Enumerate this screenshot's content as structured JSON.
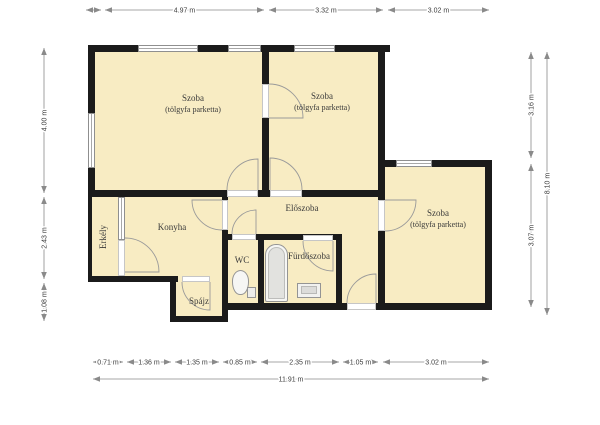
{
  "colors": {
    "room_fill": "#F8ECC3",
    "wall": "#1b1b1b",
    "dim_line": "#8a8a8a",
    "dim_text": "#3c3c3c",
    "door_arc": "#9a9a9a"
  },
  "plan": {
    "rooms": [
      {
        "id": "szoba-1",
        "label": "Szoba",
        "sublabel": "(tölgyfa parketta)",
        "x": 92,
        "y": 48,
        "w": 174,
        "h": 146,
        "lx": 193,
        "ly": 104
      },
      {
        "id": "szoba-2",
        "label": "Szoba",
        "sublabel": "(tölgyfa parketta)",
        "x": 266,
        "y": 48,
        "w": 116,
        "h": 146,
        "lx": 322,
        "ly": 102
      },
      {
        "id": "szoba-3",
        "label": "Szoba",
        "sublabel": "(tölgyfa parketta)",
        "x": 382,
        "y": 164,
        "w": 107,
        "h": 143,
        "lx": 438,
        "ly": 219
      },
      {
        "id": "konyha",
        "label": "Konyha",
        "x": 92,
        "y": 194,
        "w": 134,
        "h": 86,
        "lx": 172,
        "ly": 228
      },
      {
        "id": "erkely",
        "label": "Erkély",
        "rotate": true,
        "x": 88,
        "y": 194,
        "w": 34,
        "h": 86,
        "lx": 104,
        "ly": 237
      },
      {
        "id": "eloszoba",
        "label": "Előszoba",
        "x": 228,
        "y": 194,
        "w": 154,
        "h": 46,
        "lx": 302,
        "ly": 209
      },
      {
        "id": "eloszoba-folyoso",
        "label": "",
        "x": 342,
        "y": 240,
        "w": 40,
        "h": 67,
        "lx": 0,
        "ly": 0
      },
      {
        "id": "wc",
        "label": "WC",
        "x": 228,
        "y": 240,
        "w": 34,
        "h": 66,
        "lx": 242,
        "ly": 261
      },
      {
        "id": "furdoszoba",
        "label": "Fürdőszoba",
        "x": 262,
        "y": 240,
        "w": 77,
        "h": 66,
        "lx": 309,
        "ly": 257
      },
      {
        "id": "spajz",
        "label": "Spájz",
        "x": 172,
        "y": 280,
        "w": 52,
        "h": 40,
        "lx": 199,
        "ly": 302
      }
    ],
    "walls": [
      [
        88,
        45,
        302,
        7
      ],
      [
        88,
        45,
        7,
        151
      ],
      [
        262,
        45,
        7,
        151
      ],
      [
        378,
        45,
        7,
        265
      ],
      [
        88,
        190,
        297,
        7
      ],
      [
        385,
        160,
        107,
        7
      ],
      [
        485,
        160,
        7,
        150
      ],
      [
        378,
        303,
        114,
        7
      ],
      [
        222,
        303,
        156,
        7
      ],
      [
        222,
        190,
        6,
        132
      ],
      [
        88,
        197,
        4,
        83
      ],
      [
        88,
        276,
        90,
        6
      ],
      [
        258,
        240,
        6,
        63
      ],
      [
        336,
        240,
        6,
        63
      ],
      [
        228,
        234,
        114,
        6
      ],
      [
        170,
        282,
        6,
        40
      ],
      [
        170,
        316,
        58,
        6
      ]
    ],
    "windows": [
      [
        138,
        45,
        60,
        7,
        "h"
      ],
      [
        228,
        45,
        33,
        7,
        "h"
      ],
      [
        294,
        45,
        41,
        7,
        "h"
      ],
      [
        396,
        160,
        36,
        7,
        "h"
      ],
      [
        88,
        113,
        7,
        55,
        "v"
      ],
      [
        118,
        197,
        7,
        43,
        "v"
      ]
    ],
    "openings": [
      [
        262,
        84,
        7,
        34,
        "v"
      ],
      [
        227,
        190,
        31,
        7,
        "h"
      ],
      [
        270,
        190,
        32,
        7,
        "h"
      ],
      [
        378,
        200,
        7,
        31,
        "v"
      ],
      [
        222,
        200,
        6,
        30,
        "v"
      ],
      [
        118,
        240,
        7,
        36,
        "v"
      ],
      [
        182,
        276,
        28,
        6,
        "h"
      ],
      [
        232,
        234,
        24,
        6,
        "h"
      ],
      [
        303,
        235,
        30,
        6,
        "h"
      ],
      [
        347,
        303,
        29,
        7,
        "h"
      ]
    ],
    "doors": [
      "M 269 84 A 34 34 0 0 1 303 118 L 269 118",
      "M 258 190 L 258 159 A 31 31 0 0 0 227 190",
      "M 270 190 L 270 158 A 32 32 0 0 1 302 190",
      "M 385 231 A 31 31 0 0 0 416 200 L 385 200",
      "M 222 200 L 192 200 A 30 30 0 0 0 222 230",
      "M 125 238 A 34 34 0 0 1 159 272 L 125 272",
      "M 182 282 A 28 28 0 0 0 210 310 L 210 282",
      "M 256 234 L 256 210 A 24 24 0 0 0 232 234",
      "M 303 241 A 30 30 0 0 0 333 271 L 333 241",
      "M 376 303 L 376 274 A 29 29 0 0 0 347 303"
    ]
  },
  "dimensions": [
    {
      "o": "h",
      "x1": 86,
      "x2": 101,
      "y": 10,
      "label": ""
    },
    {
      "o": "h",
      "x1": 105,
      "x2": 264,
      "y": 10,
      "label": "4.97 m"
    },
    {
      "o": "h",
      "x1": 269,
      "x2": 383,
      "y": 10,
      "label": "3.32 m"
    },
    {
      "o": "h",
      "x1": 388,
      "x2": 489,
      "y": 10,
      "label": "3.02 m"
    },
    {
      "o": "v",
      "x": 44,
      "y1": 48,
      "y2": 193,
      "label": "4.00 m"
    },
    {
      "o": "v",
      "x": 44,
      "y1": 197,
      "y2": 279,
      "label": "2.43 m"
    },
    {
      "o": "v",
      "x": 44,
      "y1": 283,
      "y2": 321,
      "label": "1.08 m"
    },
    {
      "o": "v",
      "x": 531,
      "y1": 52,
      "y2": 158,
      "label": "3.16 m"
    },
    {
      "o": "v",
      "x": 531,
      "y1": 164,
      "y2": 307,
      "label": "3.07 m"
    },
    {
      "o": "v",
      "x": 547,
      "y1": 52,
      "y2": 315,
      "label": "8.10 m"
    },
    {
      "o": "h",
      "x1": 93,
      "x2": 123,
      "y": 362,
      "label": "0.71 m"
    },
    {
      "o": "h",
      "x1": 127,
      "x2": 171,
      "y": 362,
      "label": "1.36 m"
    },
    {
      "o": "h",
      "x1": 175,
      "x2": 219,
      "y": 362,
      "label": "1.35 m"
    },
    {
      "o": "h",
      "x1": 223,
      "x2": 257,
      "y": 362,
      "label": "0.85 m"
    },
    {
      "o": "h",
      "x1": 261,
      "x2": 339,
      "y": 362,
      "label": "2.35 m"
    },
    {
      "o": "h",
      "x1": 343,
      "x2": 378,
      "y": 362,
      "label": "1.05 m"
    },
    {
      "o": "h",
      "x1": 383,
      "x2": 489,
      "y": 362,
      "label": "3.02 m"
    },
    {
      "o": "h",
      "x1": 93,
      "x2": 489,
      "y": 379,
      "label": "11.91 m"
    }
  ]
}
